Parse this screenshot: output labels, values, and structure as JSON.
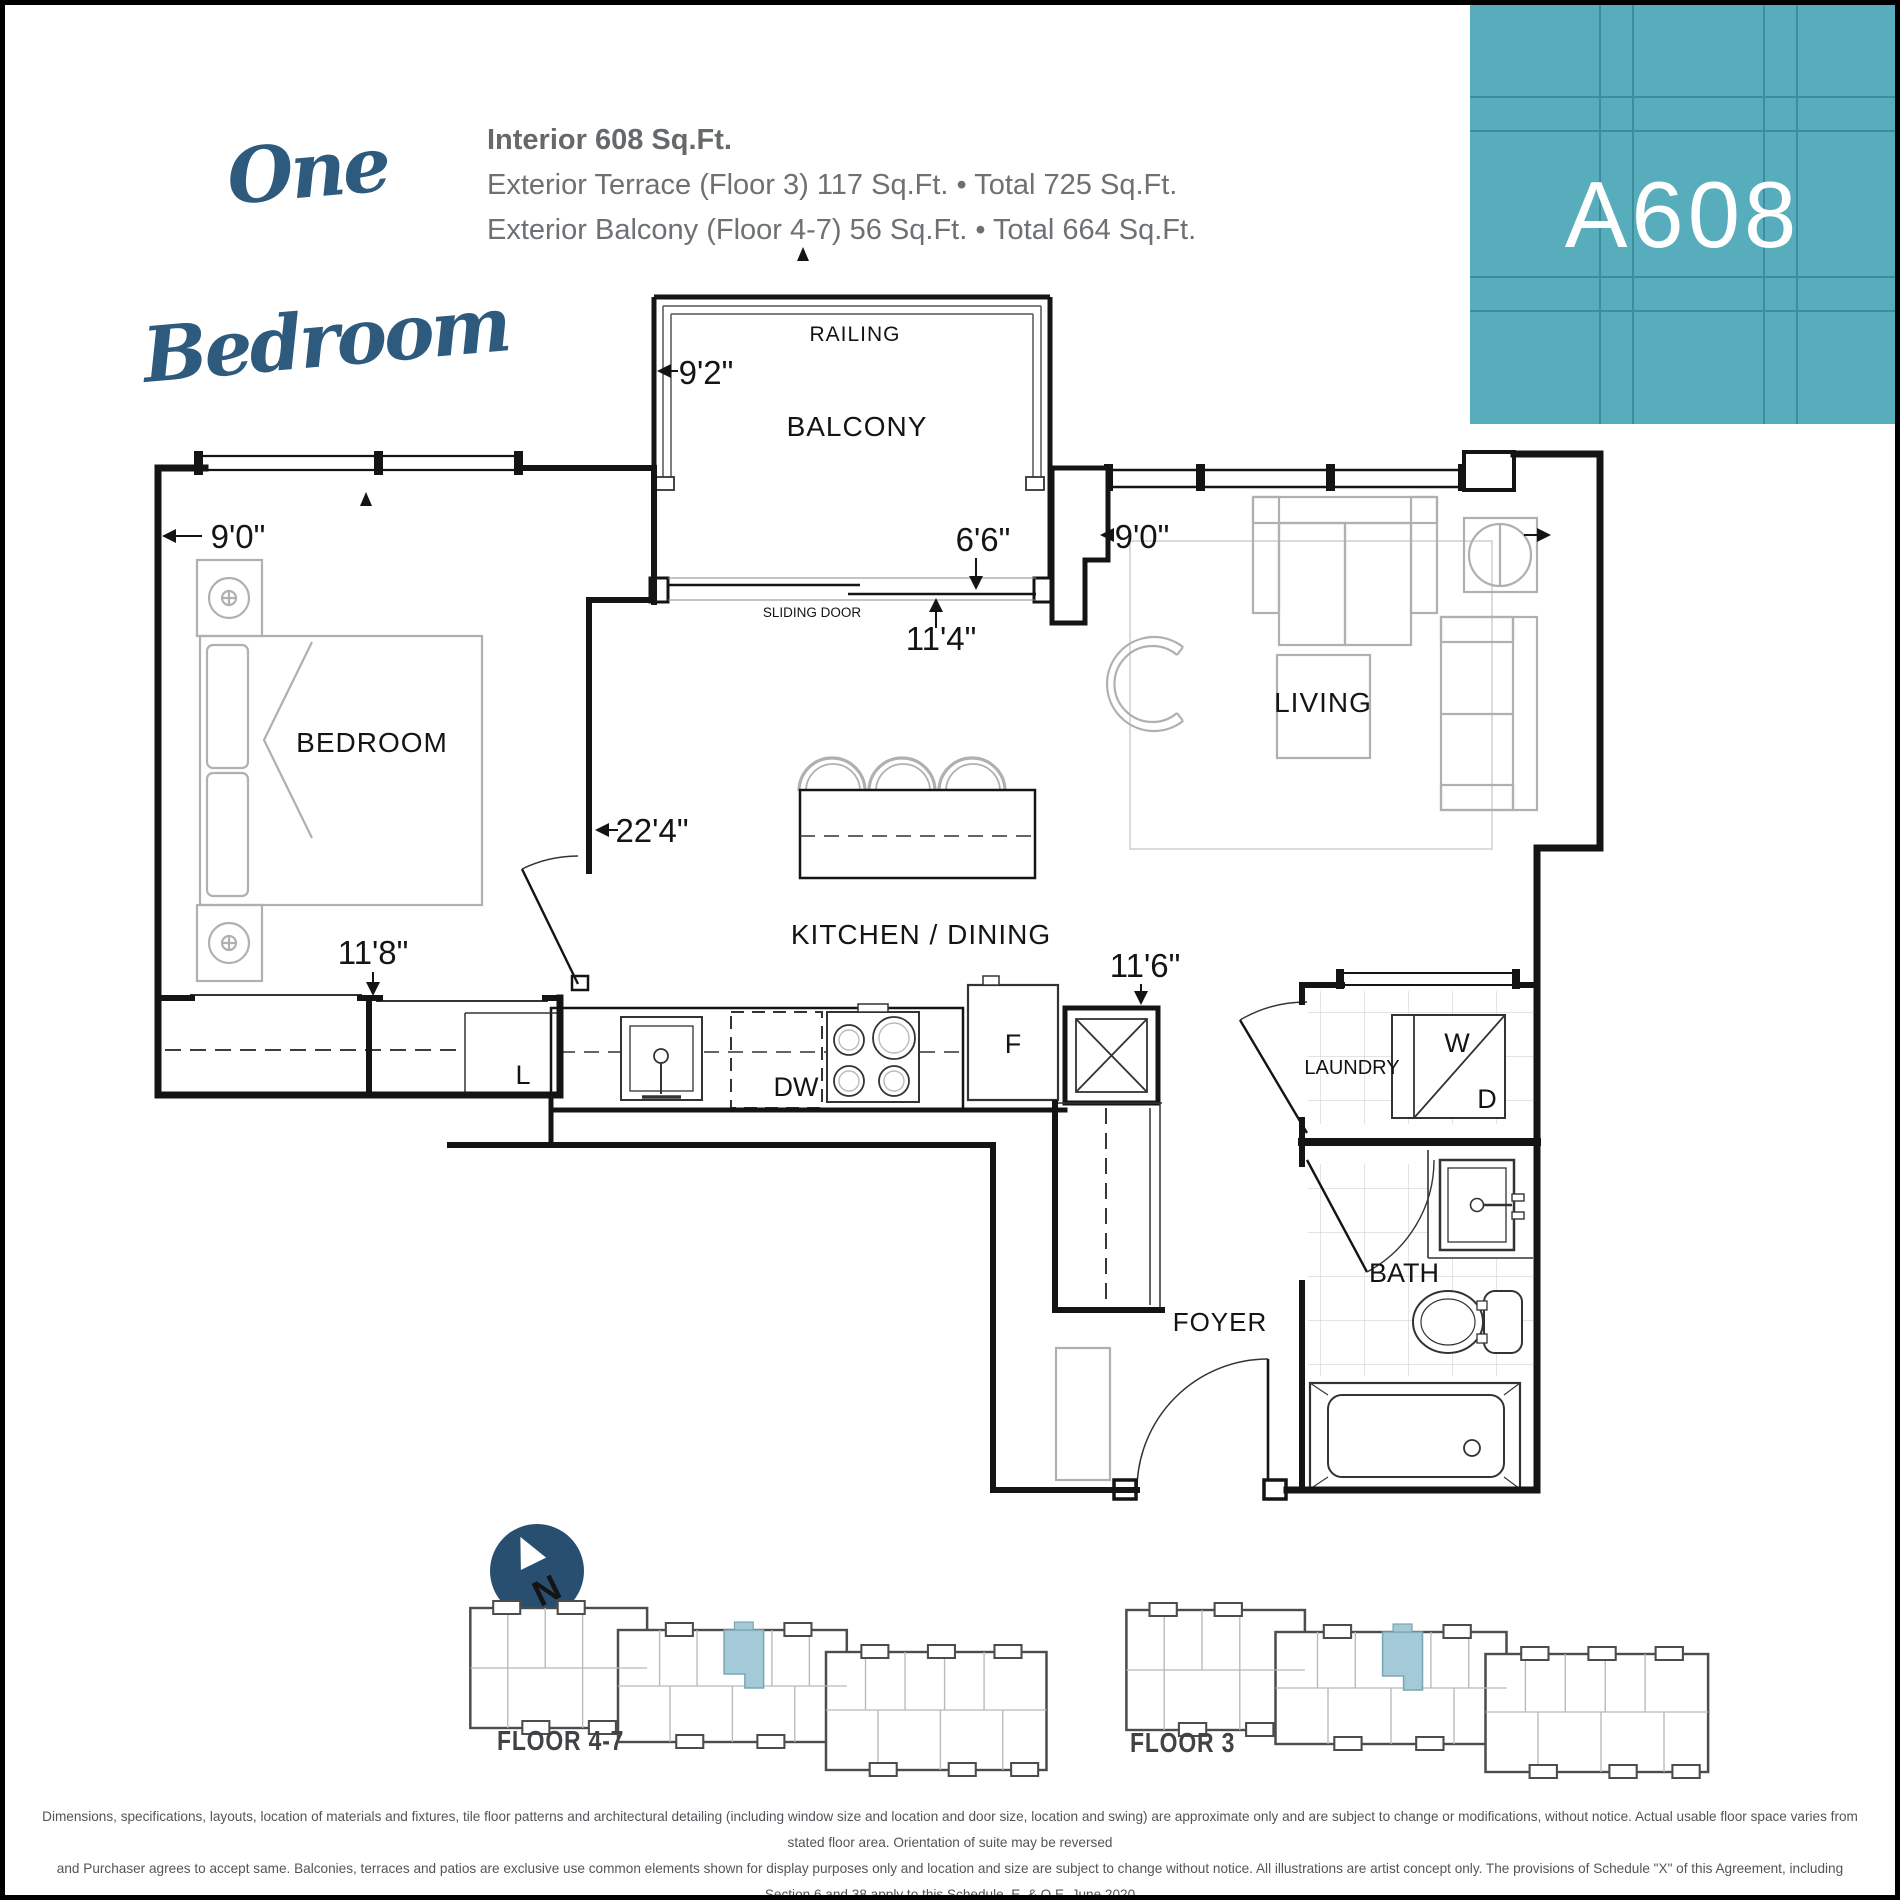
{
  "header": {
    "plan_type": "One Bedroom",
    "info_line1": "Interior 608 Sq.Ft.",
    "info_line2": "Exterior Terrace (Floor 3) 117 Sq.Ft. • Total 725 Sq.Ft.",
    "info_line3": "Exterior Balcony (Floor 4-7) 56 Sq.Ft. • Total 664 Sq.Ft.",
    "unit_number": "A608"
  },
  "floor_plan": {
    "room_labels": {
      "railing": "RAILING",
      "balcony": "BALCONY",
      "sliding_door": "SLIDING DOOR",
      "bedroom": "BEDROOM",
      "living": "LIVING",
      "kitchen_dining": "KITCHEN / DINING",
      "laundry": "LAUNDRY",
      "bath": "BATH",
      "foyer": "FOYER"
    },
    "fixture_labels": {
      "dishwasher": "DW",
      "fridge": "F",
      "linen_closet": "L",
      "washer": "W",
      "dryer": "D"
    },
    "dimensions": {
      "balcony_depth": "9'2\"",
      "bedroom_width": "9'0\"",
      "terrace_door_width": "6'6\"",
      "kitchen_dining_width": "11'4\"",
      "living_width": "9'0\"",
      "suite_depth": "22'4\"",
      "bedroom_depth": "11'8\"",
      "foyer_width": "11'6\""
    }
  },
  "key_plans": {
    "north_label": "N",
    "plan1_label": "FLOOR 4-7",
    "plan2_label": "FLOOR 3"
  },
  "disclaimer": {
    "line1": "Dimensions, specifications, layouts, location of materials and fixtures, tile floor patterns and architectural detailing (including window size and location and door size, location and swing) are approximate only and are subject to change or modifications, without notice. Actual usable floor space varies from stated floor area. Orientation of suite may be reversed",
    "line2": "and Purchaser agrees to accept same. Balconies, terraces and patios are exclusive use common elements shown for display purposes only and location and size are subject to change without notice. All illustrations are artist concept only. The provisions of Schedule \"X\" of this Agreement, including Section 6 and 38 apply to this Schedule. E. & O.E. June 2020"
  }
}
